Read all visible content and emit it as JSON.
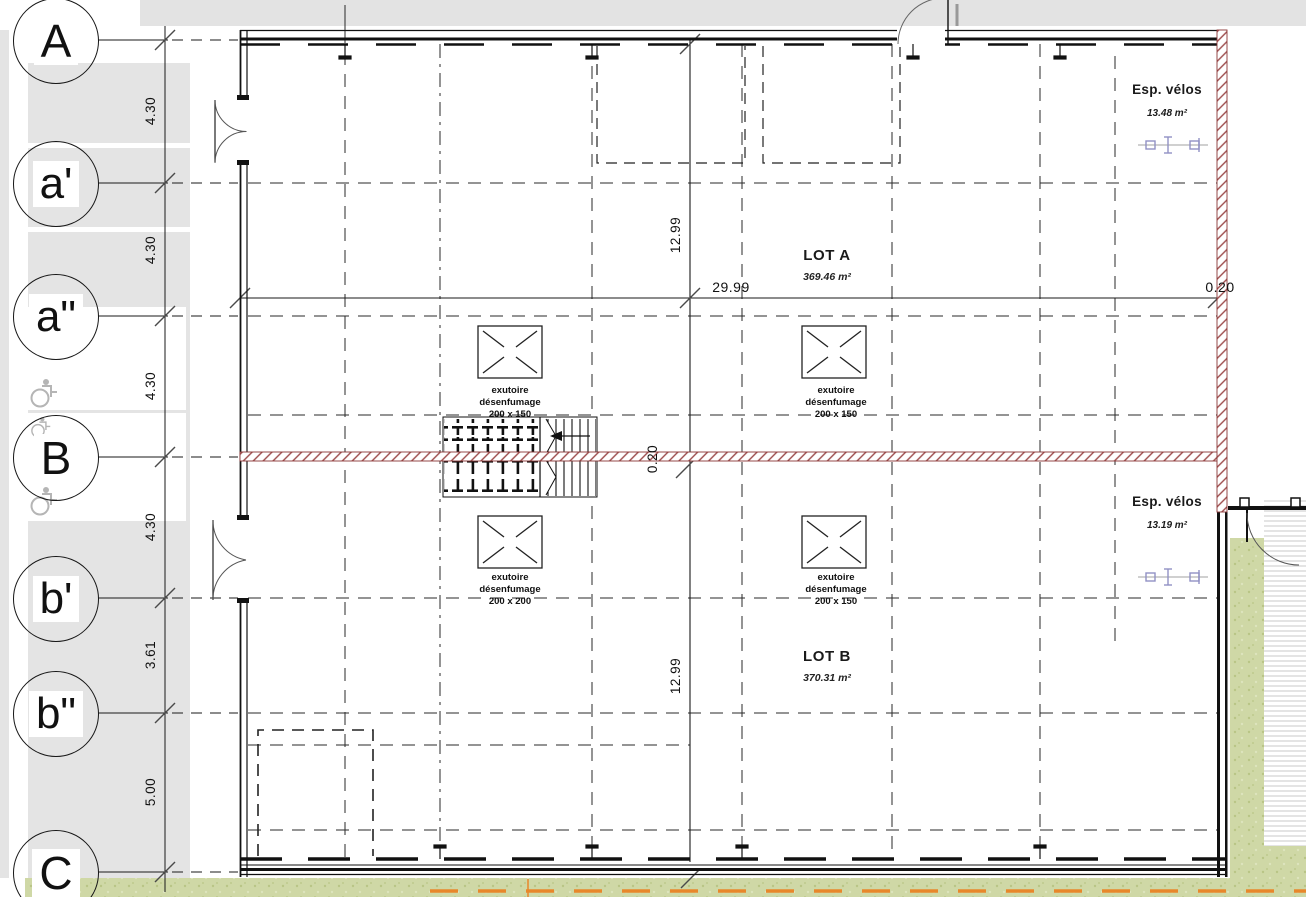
{
  "drawing": {
    "grid_axes": [
      {
        "label": "A"
      },
      {
        "label": "a'"
      },
      {
        "label": "a\""
      },
      {
        "label": "B"
      },
      {
        "label": "b'"
      },
      {
        "label": "b\""
      },
      {
        "label": "C"
      }
    ],
    "axis_dimensions": [
      "4.30",
      "4.30",
      "4.30",
      "4.30",
      "3.61",
      "5.00"
    ],
    "dimensions": {
      "building_width": "29.99",
      "lot_a_depth": "12.99",
      "lot_b_depth": "12.99",
      "east_wall_thickness": "0.20",
      "center_wall_thickness": "0.20"
    },
    "lots": [
      {
        "name": "LOT A",
        "area": "369.46 m²"
      },
      {
        "name": "LOT B",
        "area": "370.31 m²"
      }
    ],
    "bike_spaces": [
      {
        "label": "Esp. vélos",
        "area": "13.48 m²"
      },
      {
        "label": "Esp. vélos",
        "area": "13.19 m²"
      }
    ],
    "smoke_vents": [
      {
        "line1": "exutoire",
        "line2": "désenfumage",
        "size": "200 x 150"
      },
      {
        "line1": "exutoire",
        "line2": "désenfumage",
        "size": "200 x 150"
      },
      {
        "line1": "exutoire",
        "line2": "désenfumage",
        "size": "200 x 200"
      },
      {
        "line1": "exutoire",
        "line2": "désenfumage",
        "size": "200 x 150"
      }
    ],
    "icons": {
      "accessible_parking": "wheelchair-icon",
      "bike_rack": "bike-rack-icon",
      "smoke_vent": "smoke-vent-square-icon"
    },
    "colors": {
      "wall_hatch_red": "#9c4a4a",
      "grass_green": "#cfd8a6",
      "path_orange": "#e8872b",
      "bike_purple": "#9191c4",
      "panel_gray": "#e4e4e4"
    }
  }
}
